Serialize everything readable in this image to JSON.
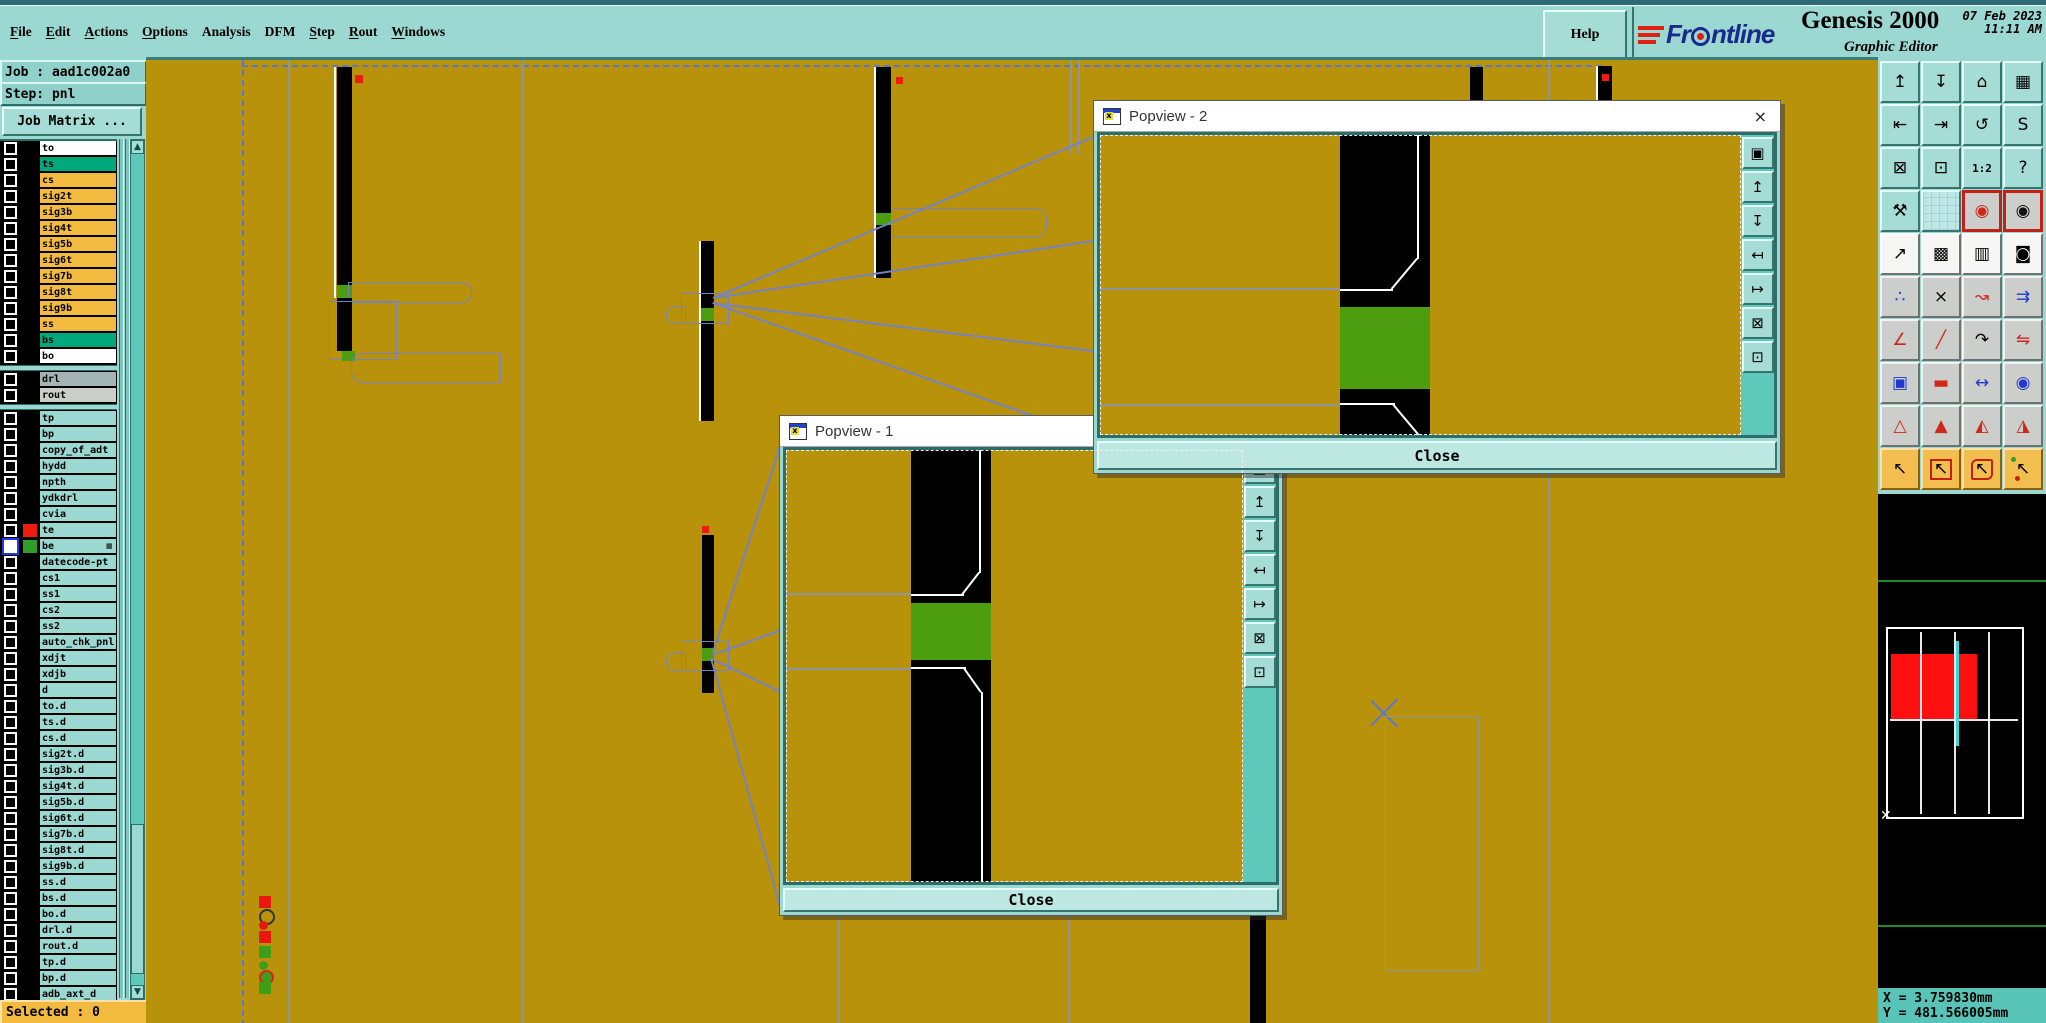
{
  "menu": {
    "items": [
      {
        "label": "File",
        "u": 0
      },
      {
        "label": "Edit",
        "u": 0
      },
      {
        "label": "Actions",
        "u": 0
      },
      {
        "label": "Options",
        "u": 0
      },
      {
        "label": "Analysis",
        "u": -1
      },
      {
        "label": "DFM",
        "u": -1
      },
      {
        "label": "Step",
        "u": 0
      },
      {
        "label": "Rout",
        "u": 0
      },
      {
        "label": "Windows",
        "u": 0
      }
    ],
    "help": "Help"
  },
  "branding": {
    "logo_pre": "Fr",
    "logo_post": "ntline",
    "logo_name": "Frontline",
    "product": "Genesis 2000",
    "date": "07 Feb 2023",
    "time": "11:11 AM",
    "subtitle": "Graphic Editor"
  },
  "job": {
    "title": "Job : aad1c002a0",
    "step": "Step: pnl",
    "matrix_button": "Job Matrix ...",
    "selected": "Selected : 0"
  },
  "layers": {
    "rows": [
      {
        "name": "to",
        "bg": "white"
      },
      {
        "name": "ts",
        "bg": "teal"
      },
      {
        "name": "cs",
        "bg": "orange"
      },
      {
        "name": "sig2t",
        "bg": "orange"
      },
      {
        "name": "sig3b",
        "bg": "orange"
      },
      {
        "name": "sig4t",
        "bg": "orange"
      },
      {
        "name": "sig5b",
        "bg": "orange"
      },
      {
        "name": "sig6t",
        "bg": "orange"
      },
      {
        "name": "sig7b",
        "bg": "orange"
      },
      {
        "name": "sig8t",
        "bg": "orange"
      },
      {
        "name": "sig9b",
        "bg": "orange"
      },
      {
        "name": "ss",
        "bg": "orange"
      },
      {
        "name": "bs",
        "bg": "teal"
      },
      {
        "name": "bo",
        "bg": "white"
      },
      {
        "sep": true
      },
      {
        "name": "drl",
        "bg": "gray1"
      },
      {
        "name": "rout",
        "bg": "gray2"
      },
      {
        "sep": true
      },
      {
        "name": "tp",
        "bg": "lt"
      },
      {
        "name": "bp",
        "bg": "lt"
      },
      {
        "name": "copy_of_adt",
        "bg": "lt"
      },
      {
        "name": "hydd",
        "bg": "lt"
      },
      {
        "name": "npth",
        "bg": "lt"
      },
      {
        "name": "ydkdrl",
        "bg": "lt"
      },
      {
        "name": "cvia",
        "bg": "lt"
      },
      {
        "name": "te",
        "bg": "lt",
        "chip": "#EE1C0C"
      },
      {
        "name": "be",
        "bg": "lt",
        "chip": "#2F9E28",
        "selected": true,
        "badge": true
      },
      {
        "name": "datecode-pt",
        "bg": "lt"
      },
      {
        "name": "cs1",
        "bg": "lt"
      },
      {
        "name": "ss1",
        "bg": "lt"
      },
      {
        "name": "cs2",
        "bg": "lt"
      },
      {
        "name": "ss2",
        "bg": "lt"
      },
      {
        "name": "auto_chk_pnl",
        "bg": "lt"
      },
      {
        "name": "xdjt",
        "bg": "lt"
      },
      {
        "name": "xdjb",
        "bg": "lt"
      },
      {
        "name": "d",
        "bg": "lt"
      },
      {
        "name": "to.d",
        "bg": "lt"
      },
      {
        "name": "ts.d",
        "bg": "lt"
      },
      {
        "name": "cs.d",
        "bg": "lt"
      },
      {
        "name": "sig2t.d",
        "bg": "lt"
      },
      {
        "name": "sig3b.d",
        "bg": "lt"
      },
      {
        "name": "sig4t.d",
        "bg": "lt"
      },
      {
        "name": "sig5b.d",
        "bg": "lt"
      },
      {
        "name": "sig6t.d",
        "bg": "lt"
      },
      {
        "name": "sig7b.d",
        "bg": "lt"
      },
      {
        "name": "sig8t.d",
        "bg": "lt"
      },
      {
        "name": "sig9b.d",
        "bg": "lt"
      },
      {
        "name": "ss.d",
        "bg": "lt"
      },
      {
        "name": "bs.d",
        "bg": "lt"
      },
      {
        "name": "bo.d",
        "bg": "lt"
      },
      {
        "name": "drl.d",
        "bg": "lt"
      },
      {
        "name": "rout.d",
        "bg": "lt"
      },
      {
        "name": "tp.d",
        "bg": "lt"
      },
      {
        "name": "bp.d",
        "bg": "lt"
      },
      {
        "name": "adb_axt_d",
        "bg": "lt"
      }
    ],
    "bg_colors": {
      "white": "#FFFFFF",
      "teal": "#00A87C",
      "orange": "#F2BB3F",
      "gray1": "#A2B4B6",
      "gray2": "#C9CEC9",
      "lt": "#9CD8D2"
    }
  },
  "popviews": {
    "pv1": {
      "title": "Popview - 1",
      "close": "Close"
    },
    "pv2": {
      "title": "Popview - 2",
      "close": "Close"
    },
    "toolbar": [
      {
        "name": "popview-window-icon",
        "glyph": "▣"
      },
      {
        "name": "shift-up-icon",
        "glyph": "↥"
      },
      {
        "name": "shift-down-icon",
        "glyph": "↧"
      },
      {
        "name": "shift-left-icon",
        "glyph": "↤"
      },
      {
        "name": "shift-right-icon",
        "glyph": "↦"
      },
      {
        "name": "zoom-extents-icon",
        "glyph": "⊠"
      },
      {
        "name": "zoom-center-icon",
        "glyph": "⊡"
      }
    ]
  },
  "right_toolbar": {
    "buttons": [
      {
        "name": "pan-up",
        "glyph": "↥"
      },
      {
        "name": "pan-down",
        "glyph": "↧"
      },
      {
        "name": "home-view",
        "glyph": "⌂"
      },
      {
        "name": "window-xy",
        "glyph": "▦"
      },
      {
        "name": "pan-left",
        "glyph": "⇤"
      },
      {
        "name": "pan-right",
        "glyph": "⇥"
      },
      {
        "name": "previous-view",
        "glyph": "↺"
      },
      {
        "name": "serpentine-route",
        "glyph": "S"
      },
      {
        "name": "zoom-extents",
        "glyph": "⊠"
      },
      {
        "name": "zoom-center",
        "glyph": "⊡"
      },
      {
        "name": "zoom-ratio-1-2",
        "glyph": "1:2"
      },
      {
        "name": "feature-query",
        "glyph": "?"
      },
      {
        "name": "setup-tools",
        "glyph": "⚒"
      },
      {
        "name": "grid-toggle",
        "glyph": "",
        "cls": "gridbg"
      },
      {
        "name": "netlist-ref",
        "glyph": "◉",
        "cls": "redbox",
        "color": "#D02818"
      },
      {
        "name": "netlist-cur",
        "glyph": "◉",
        "cls": "redbox",
        "color": "#101010"
      },
      {
        "name": "shape-transform",
        "glyph": "↗"
      },
      {
        "name": "layer-compare",
        "glyph": "▩"
      },
      {
        "name": "measure-ruler",
        "glyph": "▥"
      },
      {
        "name": "pad-select",
        "glyph": "◙"
      },
      {
        "name": "net-nodes",
        "glyph": "∴",
        "color": "#2038D0"
      },
      {
        "name": "delete-feature",
        "glyph": "×"
      },
      {
        "name": "move-feature",
        "glyph": "↝",
        "color": "#D02818"
      },
      {
        "name": "copy-feature",
        "glyph": "⇉",
        "color": "#2038D0"
      },
      {
        "name": "measure-angle",
        "glyph": "∠",
        "color": "#D02818"
      },
      {
        "name": "draw-line",
        "glyph": "╱",
        "color": "#D02818"
      },
      {
        "name": "draw-arc",
        "glyph": "↷"
      },
      {
        "name": "mirror-flip",
        "glyph": "⇋",
        "color": "#D02818"
      },
      {
        "name": "copy-to-layer",
        "glyph": "▣",
        "color": "#2038D0"
      },
      {
        "name": "trace-width",
        "glyph": "▬",
        "color": "#D02818"
      },
      {
        "name": "measure-distance",
        "glyph": "↔",
        "color": "#2038D0"
      },
      {
        "name": "surface-shapes",
        "glyph": "◉",
        "color": "#2038D0"
      },
      {
        "name": "rout-angle-1",
        "glyph": "△",
        "color": "#D02818"
      },
      {
        "name": "rout-angle-2",
        "glyph": "▲",
        "color": "#D02818"
      },
      {
        "name": "rout-angle-3",
        "glyph": "◭",
        "color": "#D02818"
      },
      {
        "name": "rout-angle-4",
        "glyph": "◮",
        "color": "#D02818"
      },
      {
        "name": "select-single",
        "glyph": "↖"
      },
      {
        "name": "select-frame",
        "glyph": "↖",
        "cls": "cframe"
      },
      {
        "name": "select-polygon",
        "glyph": "↖",
        "cls": "cpoly"
      },
      {
        "name": "select-net",
        "glyph": "↖",
        "cls": "cnet"
      }
    ]
  },
  "status": {
    "x": "X = 3.759830mm",
    "y": "Y = 481.566005mm"
  },
  "colors": {
    "canvas_olive": "#B8920A",
    "pad_green": "#4C9E10",
    "selection_blue": "#5878D0",
    "outline_slate": "#7483C6",
    "accent_red": "#EE1C0C",
    "panel_teal": "#9CD8D2",
    "map_red": "#FF1010",
    "map_cyan": "#30D8D8"
  }
}
